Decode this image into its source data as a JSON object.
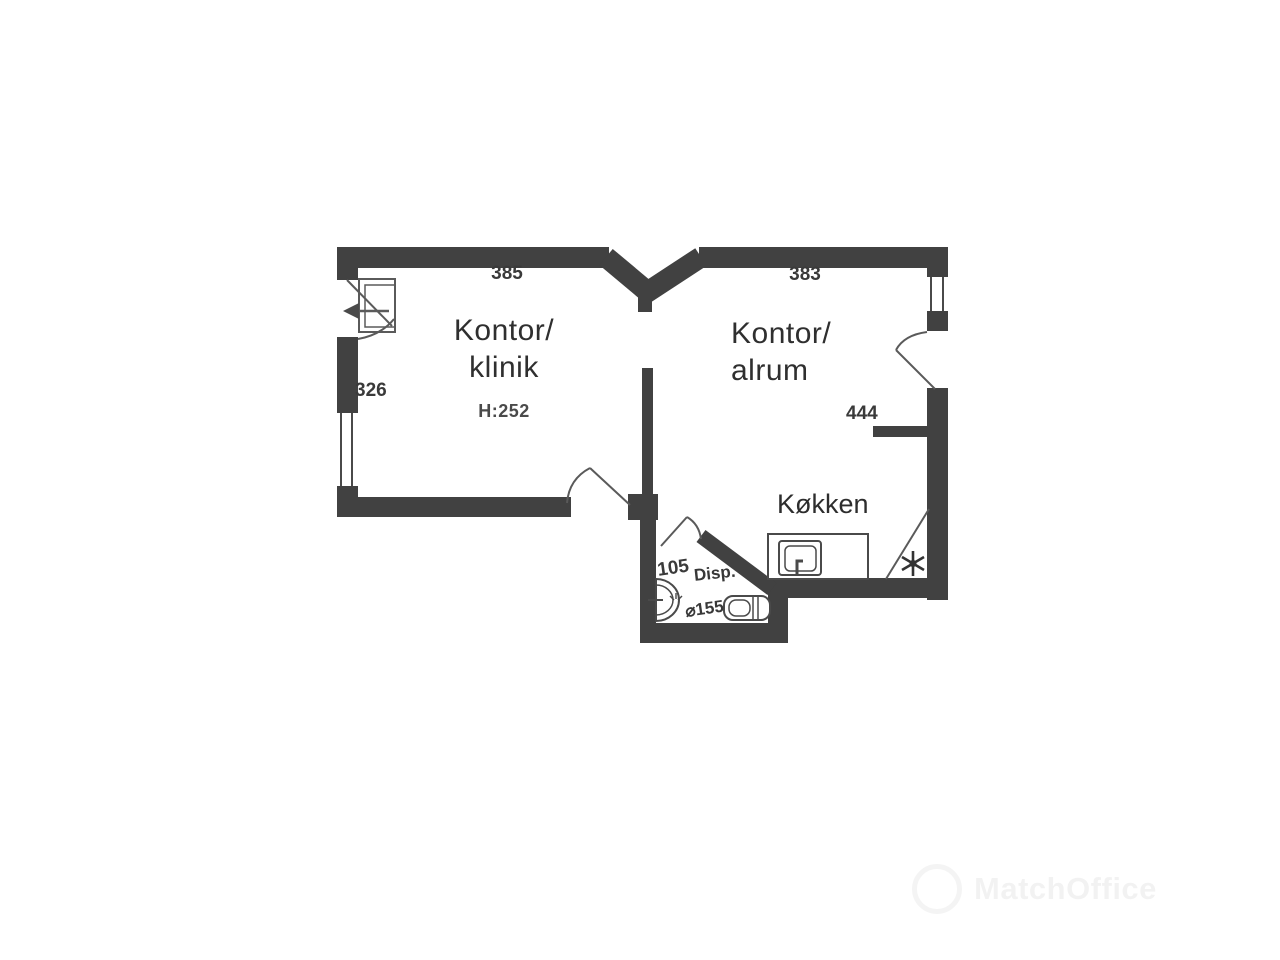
{
  "document": {
    "type": "floor-plan"
  },
  "colors": {
    "wall": "#414141",
    "line": "#4a4a4a",
    "text": "#343434",
    "background": "#ffffff"
  },
  "plan": {
    "rooms": {
      "kontor_klinik": {
        "name_line1": "Kontor/",
        "name_line2": "klinik",
        "ceiling_height": "H:252",
        "top_dim": "385",
        "side_dim": "326"
      },
      "kontor_alrum": {
        "name_line1": "Kontor/",
        "name_line2": "alrum",
        "top_dim": "383",
        "inner_dim": "444"
      },
      "kokken": {
        "name": "Køkken"
      },
      "disp": {
        "area_dim": "105",
        "name": "Disp.",
        "turning_circle": "⌀155"
      }
    }
  },
  "watermark": {
    "text": "MatchOffice"
  }
}
